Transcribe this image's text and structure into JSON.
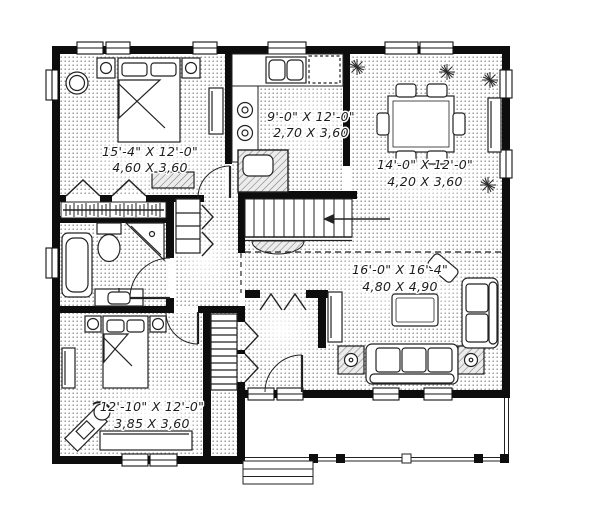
{
  "plan": {
    "type": "single-storey house floor plan",
    "rooms": [
      {
        "name": "bedroom-primary",
        "imperial": "15'-4\" X 12'-0\"",
        "metric": "4,60 X 3,60"
      },
      {
        "name": "kitchen",
        "imperial": "9'-0\" X 12'-0\"",
        "metric": "2,70 X 3,60"
      },
      {
        "name": "dining-room",
        "imperial": "14'-0\" X 12'-0\"",
        "metric": "4,20 X 3,60"
      },
      {
        "name": "living-room",
        "imperial": "16'-0\" X 16'-4\"",
        "metric": "4,80 X 4,90"
      },
      {
        "name": "bedroom-secondary",
        "imperial": "12'-10\" X 12'-0\"",
        "metric": "3,85 X 3,60"
      }
    ],
    "colors": {
      "wall": "#0d0d0d",
      "paper": "#ffffff",
      "ink": "#222222",
      "tone": "#8f8f8f"
    }
  }
}
